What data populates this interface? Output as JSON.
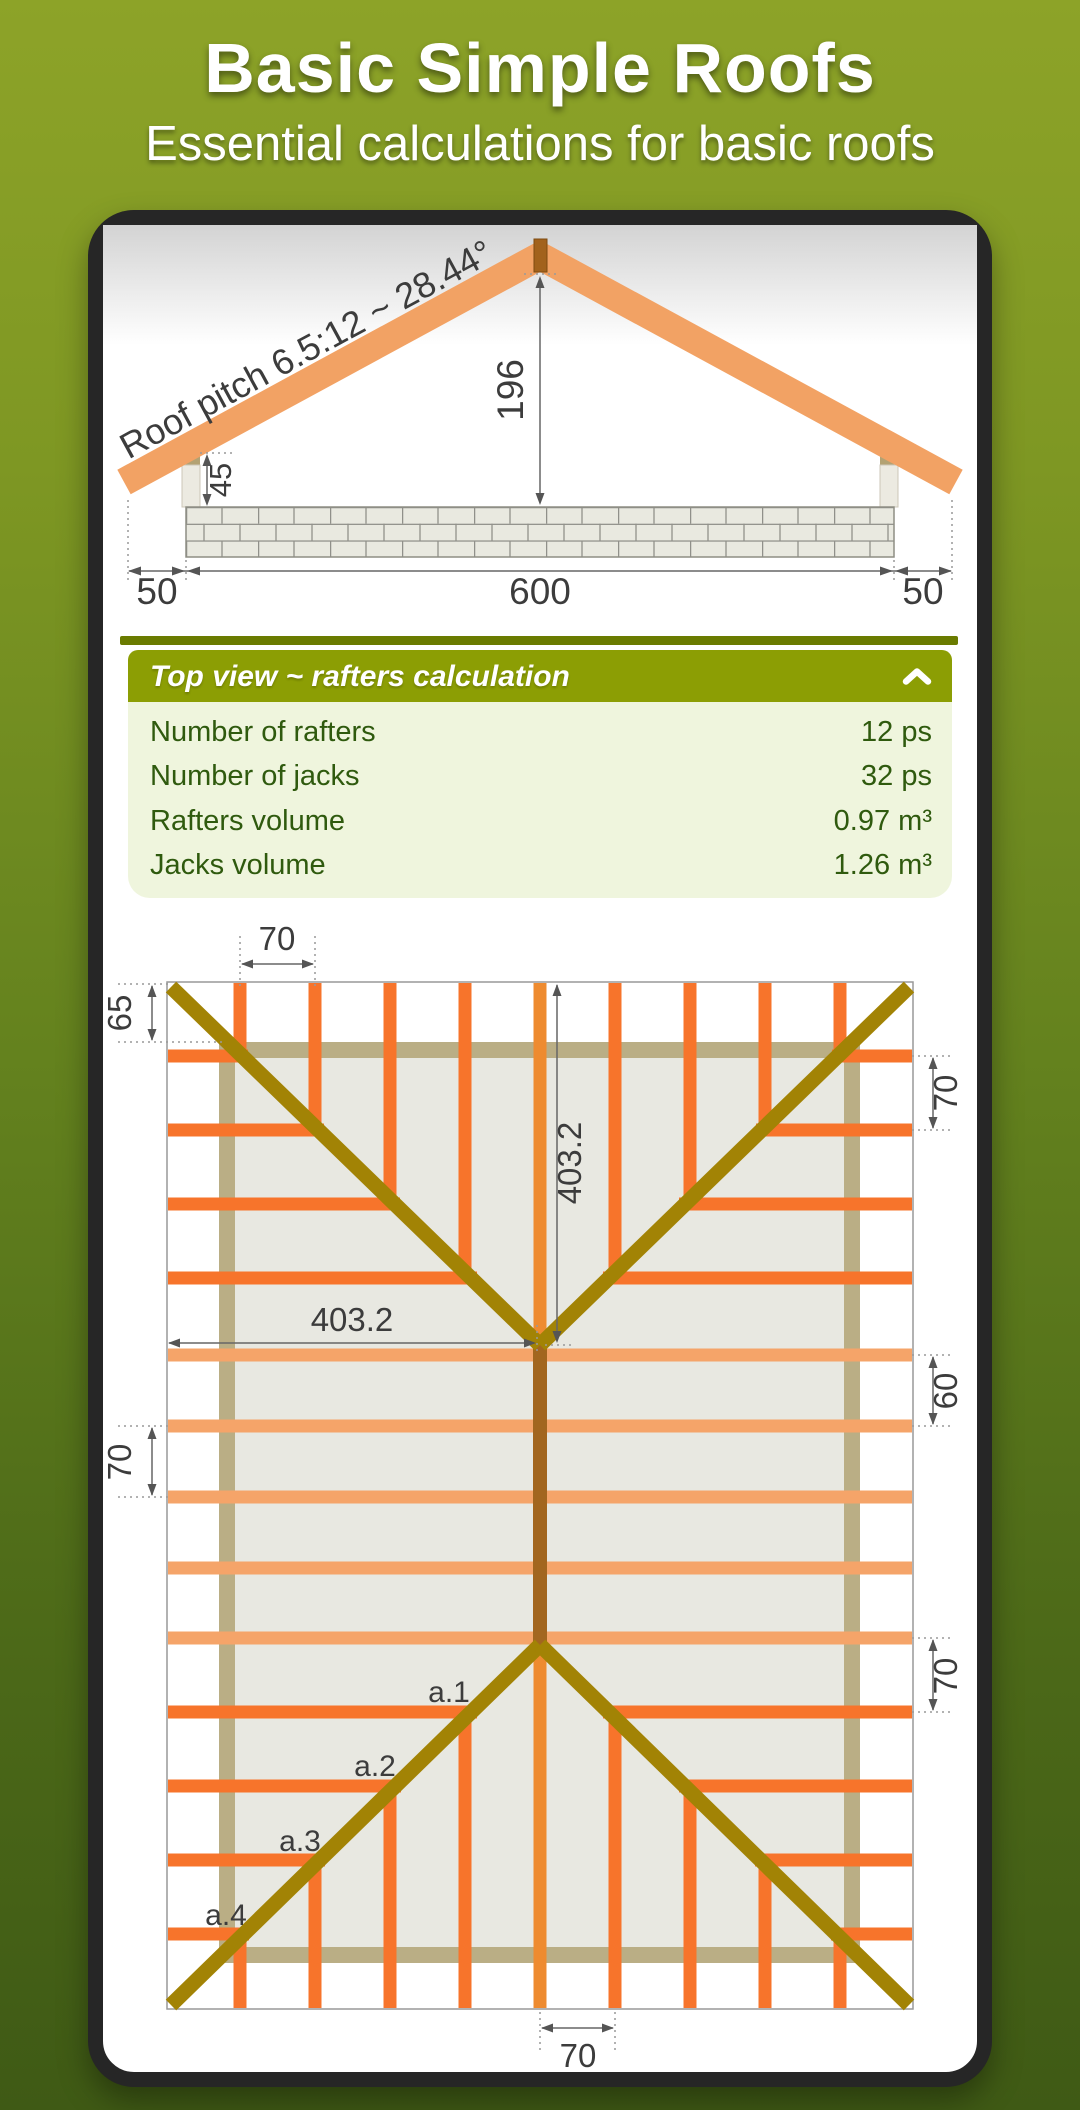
{
  "banner": {
    "title": "Basic Simple Roofs",
    "subtitle": "Essential calculations for basic roofs"
  },
  "cross_section": {
    "pitch_label": "Roof pitch 6.5:12 ~ 28.44°",
    "dims": {
      "ridge_height": "196",
      "post_height": "45",
      "overhang_left": "50",
      "span": "600",
      "overhang_right": "50"
    }
  },
  "panel": {
    "title": "Top view ~ rafters calculation",
    "collapse_icon": "chevron-up",
    "rows": [
      {
        "label": "Number of rafters",
        "value": "12 ps"
      },
      {
        "label": "Number of jacks",
        "value": "32 ps"
      },
      {
        "label": "Rafters volume",
        "value": "0.97 m³"
      },
      {
        "label": "Jacks volume",
        "value": "1.26 m³"
      }
    ]
  },
  "top_view": {
    "dims": {
      "rafter_spacing_top": "70",
      "eave_offset_left": "65",
      "apex_from_top": "403.2",
      "apex_from_left": "403.2",
      "rafter_spacing_left": "70",
      "jack_spacing_right_top": "70",
      "rafter_spacing_right": "60",
      "jack_spacing_right_bottom": "70",
      "rafter_spacing_bottom": "70"
    },
    "jack_labels": [
      "a.1",
      "a.2",
      "a.3",
      "a.4"
    ]
  },
  "colors": {
    "background_top": "#8DA328",
    "background_bottom": "#3F5A15",
    "header_green": "#8C9E04",
    "divider_green": "#6A7B00",
    "panel_body_green": "#EFF5DD",
    "panel_text_green": "#2F5A0E",
    "jack_rafter_orange": "#F7742B",
    "common_rafter_orange": "#F5A469",
    "cross_rafter_orange": "#F2A264",
    "hip_gold": "#A28305",
    "ridge_brown": "#A2661F",
    "wall_tan": "#BAAE85"
  }
}
